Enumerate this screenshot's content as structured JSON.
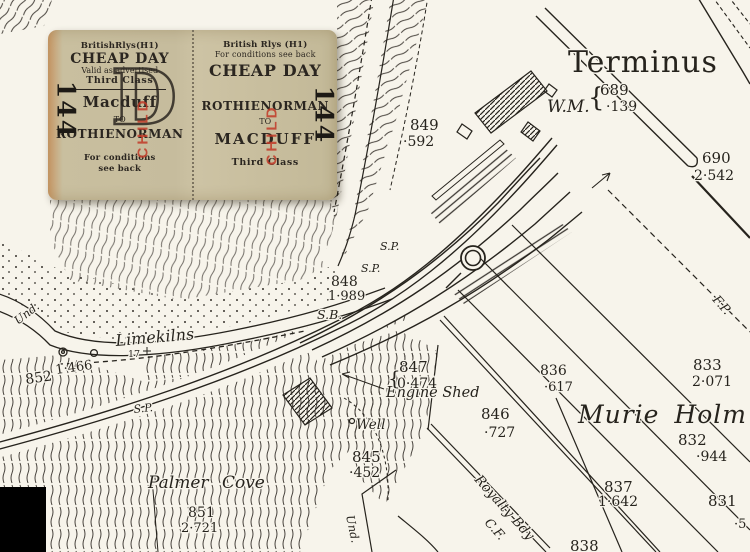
{
  "ticket": {
    "stamp_color": "#c23a28",
    "left": {
      "header": "BritishRlys(H1)",
      "type": "CHEAP DAY",
      "valid": "Valid as advertised",
      "class": "Third Class",
      "from": "Macduff",
      "to_word": "TO",
      "to": "ROTHIENORMAN",
      "conditions1": "For conditions",
      "conditions2": "see back",
      "big_letter": "D",
      "serial": "144",
      "stamp": "CHILD"
    },
    "right": {
      "header": "British Rlys (H1)",
      "conditions_top": "For conditions see back",
      "type": "CHEAP DAY",
      "from": "ROTHIENORMAN",
      "to_word": "TO",
      "to": "MACDUFF",
      "class": "Third Class",
      "serial": "144",
      "stamp": "CHILD"
    }
  },
  "map": {
    "ink": "#26231d",
    "paper": "#f7f4eb",
    "labels": {
      "terminus": "Terminus",
      "p689": "689",
      "a689": "·139",
      "brace689": "{",
      "wm": "W.M.",
      "p690": "690",
      "a690": "2·542",
      "p849": "849",
      "a849": "·592",
      "sp1": "S.P.",
      "sp2": "S.P.",
      "sp3": "S.P.",
      "p848": "848",
      "a848": "1·989",
      "sb": "S.B.",
      "limekilns": "Limekilns",
      "bench17": "17",
      "p852": "852",
      "a852": "1·466",
      "und1": "Und.",
      "und2": "Und.",
      "engine_shed": "Engine Shed",
      "p847": "847",
      "brace847": "{",
      "a847": "0·474",
      "well": "Well",
      "p846": "846",
      "a846": "·727",
      "p845": "845",
      "a845": "·452",
      "palmer_cove": "Palmer Cove",
      "p851": "851",
      "a851": "2·721",
      "murie_holm": "Murie Holm",
      "p836": "836",
      "a836": "·617",
      "p833": "833",
      "a833": "2·071",
      "p832": "832",
      "a832": "·944",
      "p831": "831",
      "p837": "837",
      "a837": "1·642",
      "p838": "838",
      "royalty_bdy": "Royalty Bdy",
      "cf": "C.F.",
      "fp": "F.P.",
      "a831_partial": "·5"
    }
  }
}
